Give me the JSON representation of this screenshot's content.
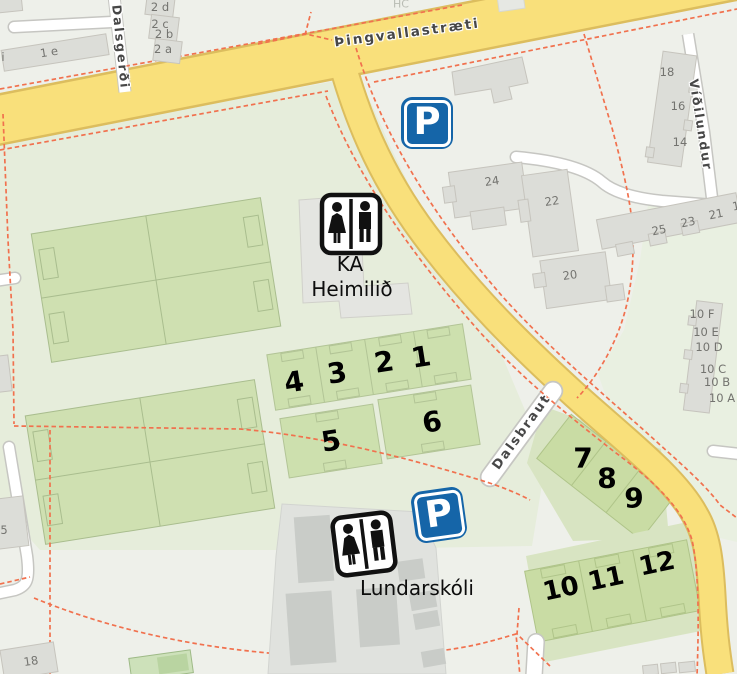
{
  "map": {
    "streets": {
      "thingvallastraeti": "Þingvallastræti",
      "dalsgerdi": "Dalsgerði",
      "vidilundur": "Víðilundur",
      "dalsbraut": "Dalsbraut"
    },
    "places": {
      "ka_line1": "KA",
      "ka_line2": "Heimilið",
      "school": "Lundarskóli"
    },
    "parking_letter": "P",
    "field_numbers": [
      "1",
      "2",
      "3",
      "4",
      "5",
      "6",
      "7",
      "8",
      "9",
      "10",
      "11",
      "12"
    ],
    "house_numbers": {
      "r2d": "2 d",
      "r2c": "2 c",
      "r2b": "2 b",
      "r2a": "2 a",
      "r1e": "1 e",
      "ri": "i",
      "v18": "18",
      "v16": "16",
      "v14": "14",
      "b24": "24",
      "b22": "22",
      "b20": "20",
      "t25": "25",
      "t23": "23",
      "t21": "21",
      "t1": "1",
      "a10f": "10 F",
      "a10e": "10 E",
      "a10d": "10 D",
      "a10c": "10 C",
      "a10b": "10 B",
      "a10a": "10 A",
      "s5": "5",
      "s18": "18",
      "hc": "HC"
    },
    "colors": {
      "road_yellow": "#f9e07b",
      "road_casing": "#dcbd5e",
      "path_dashed": "#f1714e",
      "field_green": "#cde0ae",
      "area_green": "#e6eddb",
      "building_gray": "#dcddd8",
      "parking_blue": "#1565a8"
    }
  }
}
